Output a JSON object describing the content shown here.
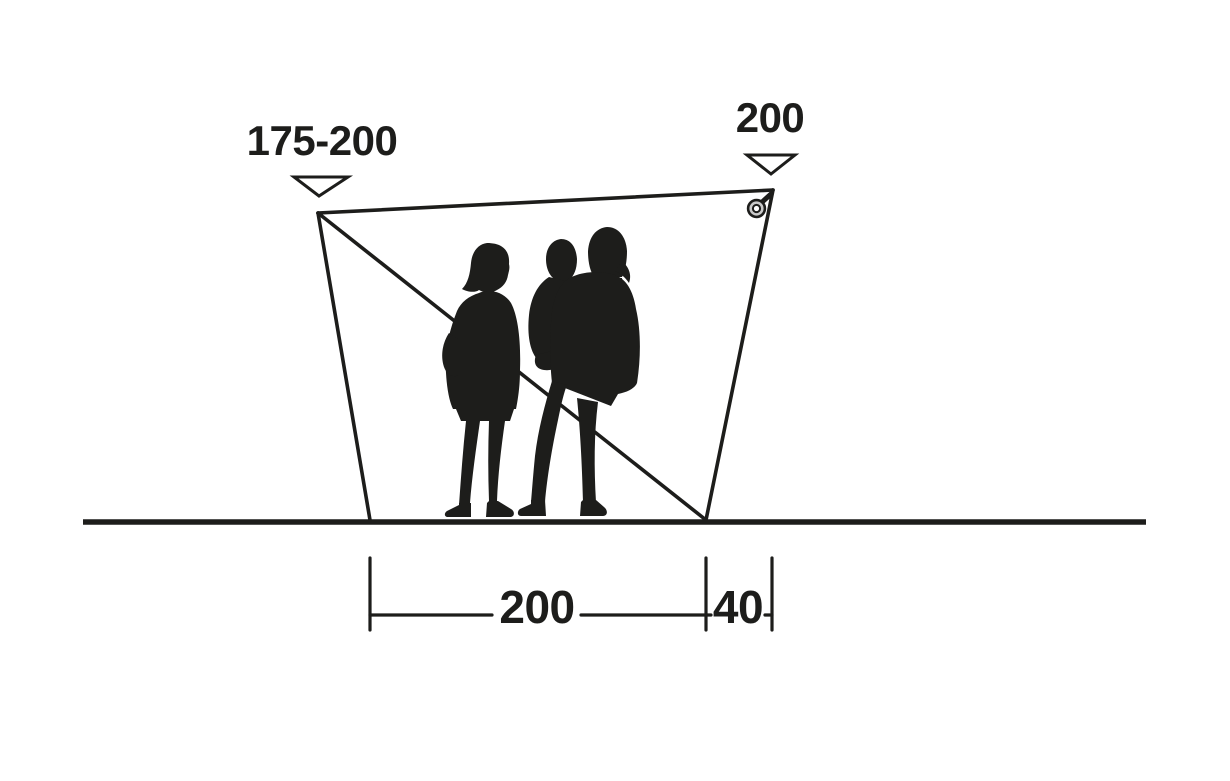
{
  "colors": {
    "ink": "#1d1d1b",
    "paper": "#ffffff",
    "grommet": "#c9c9c9"
  },
  "diagram": {
    "kind": "product-dimension-side-view",
    "subject": "tarp windscreen with two adults and a child silhouette for scale",
    "annotations": {
      "peak_left": "175-200",
      "peak_right": "200",
      "base_span": "200",
      "base_overhang": "40"
    },
    "markers": {
      "peak_left_marker": "down-triangle-outline",
      "peak_right_marker": "down-triangle-outline",
      "corner_attachment": "ring-grommet-icon"
    },
    "measure_unit_note": "",
    "figures": "two-adults-with-child-silhouette"
  }
}
